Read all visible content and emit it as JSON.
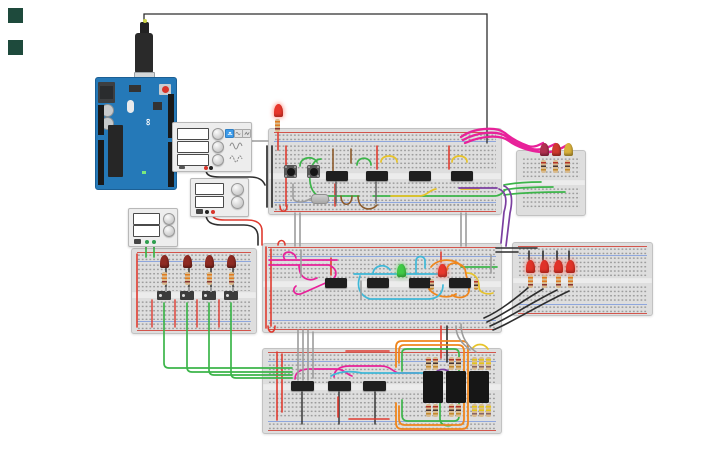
{
  "app": {
    "name": "circuit-canvas"
  },
  "decor": {
    "square_color": "#1e4a3c"
  },
  "arduino": {
    "label_brand": "ARDUINO",
    "label_model": "UNO"
  },
  "function_generator": {
    "frequency": "100 Hz",
    "amplitude": "2.22 V",
    "offset": "226 mV",
    "waveforms": [
      "square",
      "sine",
      "triangle"
    ],
    "selected_waveform": "square"
  },
  "power_supply_main": {
    "voltage": "4.50 V",
    "current": "11.2 mA"
  },
  "power_supply_aux": {
    "voltage": "0.00 V",
    "current": "0.00 A"
  },
  "ics": {
    "top": [
      "74HC74",
      "74HC74",
      "74HC74",
      "74HC74"
    ],
    "middle": [
      "74HC08",
      "74HC08",
      "74HC08",
      "74HC08"
    ],
    "bottom": [
      "74HC595",
      "74HC595",
      "74HC595"
    ]
  },
  "seven_segment": {
    "on_color": "#ff2418",
    "off_color": "#383838",
    "digits": [
      {
        "value": "",
        "dp": false
      },
      {
        "value": "",
        "dp": false
      },
      {
        "value": "8",
        "dp": true
      }
    ]
  },
  "colors": {
    "arduino_blue": "#2579b8",
    "wire_red": "#df3b30",
    "wire_black": "#2e2e2e",
    "wire_green": "#3cb54a",
    "wire_yellow": "#e7c32a",
    "wire_orange": "#ef861d",
    "wire_magenta": "#e8219a",
    "wire_purple": "#7b3fa0",
    "wire_cyan": "#3fb8d8",
    "wire_gray": "#9c9c9c",
    "wire_brown": "#8b5a2b",
    "led_red_on": "#e8372c",
    "led_red_off": "#8e2a22",
    "led_green": "#3fca46",
    "led_yellow": "#d9b13b",
    "led_crimson": "#b03050"
  }
}
